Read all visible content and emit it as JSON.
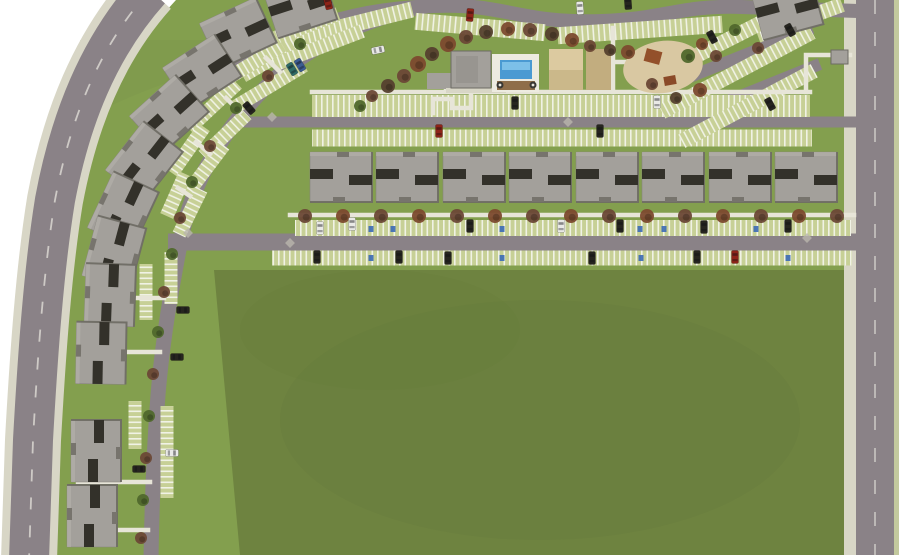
{
  "colors": {
    "page_bg": "#ffffff",
    "grass": "#839f4e",
    "grass_deep": "#76914a",
    "field": "#6e8340",
    "field_shade": "#64793a",
    "road": "#8a8287",
    "road_light": "#938c90",
    "dash": "#d9d7d1",
    "walk": "#e7e5d8",
    "verge": "#d8d6c6",
    "verge_green": "#c3c99e",
    "stripe_bg": "#c7d096",
    "stripe_white": "#f0f2e5",
    "wall": "#a3a09b",
    "wall_hi": "#b2afa9",
    "wall_edge": "#6e6b64",
    "slot": "#33312a",
    "vent": "#77746d",
    "pool": "#4a9ad2",
    "pool_hi": "#7cc0e8",
    "deck": "#edebe0",
    "patio": "#8f6e49",
    "sand": "#d9c8a2",
    "court1": "#dccaa0",
    "court2": "#cbb88a",
    "court3": "#c2ad7f",
    "equip": "#93502a",
    "kiosk": "#a3a09b",
    "diamond": "#b9b5ac",
    "handicap": "#3b6ab5",
    "tree_a": "#6b4836",
    "tree_b": "#55402e",
    "tree_g": "#50682c",
    "tree_o": "#7c4a2e",
    "car_k": "#26251f",
    "car_w": "#e9e9e6",
    "car_r": "#8e2418",
    "car_u": "#3b5c92",
    "car_t": "#2f6b66"
  },
  "canvas": {
    "w": 915,
    "h": 555
  },
  "site": {
    "grass_path": "M 176,0 C 124,55 96,130 80,210 C 68,280 62,360 57,450 L 53,558 L 899,558 L 899,0 Z",
    "field_poly": "214,270 848,270 848,555 240,555",
    "outer_road": {
      "d": "M 150,-10 C 98,48 70,120 55,200 C 44,268 38,350 33,440 L 29,560",
      "road_w": 40,
      "walk_w": 56
    },
    "right_road": {
      "verge": [
        844,
        0,
        12,
        555
      ],
      "road": [
        856,
        0,
        38,
        555
      ],
      "strip": [
        894,
        0,
        5,
        555
      ],
      "dash_x": 875
    },
    "roads": [
      {
        "d": "M 430,5 C 345,22 288,60 250,104 C 215,144 192,188 182,234 C 171,292 163,335 158,395 C 154,448 152,500 151,558",
        "w": 15
      },
      {
        "d": "M 230,74 C 292,28 352,9 434,6 C 505,3 520,24 602,21 C 665,19 680,5 742,7 L 858,11",
        "w": 14
      },
      {
        "d": "M 238,122 L 856,122",
        "w": 11
      },
      {
        "d": "M 168,242 L 858,242",
        "w": 17
      },
      {
        "d": "M 662,88 L 812,28",
        "w": 12
      },
      {
        "d": "M 676,122 L 820,64",
        "w": 12
      }
    ],
    "bands": [
      [
        573,
        228,
        556,
        16,
        0
      ],
      [
        562,
        258,
        580,
        15,
        0
      ],
      [
        561,
        106,
        498,
        22,
        0
      ],
      [
        562,
        138,
        500,
        17,
        0
      ],
      [
        282,
        52,
        92,
        16,
        -30
      ],
      [
        354,
        24,
        120,
        16,
        -14
      ],
      [
        480,
        27,
        130,
        17,
        5
      ],
      [
        640,
        30,
        165,
        17,
        -4
      ],
      [
        800,
        20,
        90,
        15,
        -20
      ],
      [
        747,
        30,
        120,
        15,
        -27
      ],
      [
        737,
        72,
        170,
        15,
        -28
      ],
      [
        748,
        106,
        150,
        15,
        -28
      ],
      [
        318,
        48,
        95,
        14,
        -21
      ],
      [
        270,
        86,
        80,
        14,
        -31
      ],
      [
        225,
        135,
        60,
        14,
        -44
      ],
      [
        205,
        170,
        62,
        14,
        -53
      ],
      [
        190,
        212,
        50,
        14,
        -64
      ],
      [
        296,
        30,
        90,
        14,
        -21
      ],
      [
        248,
        66,
        80,
        14,
        -31
      ],
      [
        213,
        106,
        66,
        14,
        -43
      ],
      [
        188,
        150,
        56,
        14,
        -55
      ],
      [
        176,
        195,
        46,
        14,
        -66
      ],
      [
        171,
        278,
        52,
        13,
        90
      ],
      [
        146,
        292,
        56,
        13,
        90
      ],
      [
        167,
        452,
        92,
        13,
        90
      ],
      [
        135,
        425,
        48,
        13,
        90
      ]
    ],
    "walks": [
      "M 290,215 L 854,215",
      "M 312,92 L 810,92",
      "M 433,113 L 433,99 L 452,99 L 452,108 L 471,108 L 471,92",
      "M 806,92 L 806,55 L 850,55",
      "M 613,92 L 613,28",
      "M 613,62 L 650,62",
      "M 650,62 L 650,92",
      "M 130,298 L 164,298",
      "M 125,352 L 160,352",
      "M 78,482 L 150,482",
      "M 99,456 L 99,482",
      "M 118,530 L 148,530",
      "M 266,58 L 280,72",
      "M 226,98 L 240,112",
      "M 196,142 L 210,154",
      "M 178,188 L 190,196",
      "M 446,90 L 506,90"
    ],
    "buildings": [
      [
        341,
        177,
        0
      ],
      [
        407,
        177,
        0
      ],
      [
        474,
        177,
        0
      ],
      [
        540,
        177,
        0
      ],
      [
        607,
        177,
        0
      ],
      [
        673,
        177,
        0
      ],
      [
        740,
        177,
        0
      ],
      [
        806,
        177,
        0
      ],
      [
        300,
        5,
        -18
      ],
      [
        238,
        33,
        -25
      ],
      [
        202,
        72,
        -33
      ],
      [
        169,
        114,
        -42
      ],
      [
        144,
        161,
        -52
      ],
      [
        123,
        210,
        -65
      ],
      [
        114,
        252,
        -75
      ],
      [
        110,
        295,
        -88
      ],
      [
        101,
        353,
        -89
      ],
      [
        96,
        451,
        -90
      ],
      [
        92,
        516,
        -90
      ],
      [
        787,
        8,
        -15
      ]
    ],
    "amenity": [
      {
        "t": "rect",
        "x": 427,
        "y": 73,
        "w": 26,
        "h": 16,
        "f": "$wall"
      },
      {
        "t": "rect",
        "x": 446,
        "y": 88,
        "w": 60,
        "h": 5,
        "f": "$verge"
      },
      {
        "t": "rect",
        "x": 451,
        "y": 51,
        "w": 40,
        "h": 37,
        "f": "$wall",
        "s": "$wall_edge"
      },
      {
        "t": "rect",
        "x": 456,
        "y": 56,
        "w": 22,
        "h": 27,
        "f": "#989590"
      },
      {
        "t": "rect",
        "x": 492,
        "y": 54,
        "w": 47,
        "h": 38,
        "f": "$deck"
      },
      {
        "t": "rect",
        "x": 500,
        "y": 60,
        "w": 32,
        "h": 19,
        "f": "$pool"
      },
      {
        "t": "rect",
        "x": 502,
        "y": 62,
        "w": 28,
        "h": 8,
        "f": "$pool_hi"
      },
      {
        "t": "rect",
        "x": 497,
        "y": 81,
        "w": 38,
        "h": 9,
        "f": "$patio"
      },
      {
        "t": "circle",
        "x": 500,
        "y": 85,
        "r": 3.5,
        "f": "#3a3833"
      },
      {
        "t": "circle",
        "x": 500,
        "y": 85,
        "r": 1.4,
        "f": "#e8e6dd"
      },
      {
        "t": "circle",
        "x": 533,
        "y": 85,
        "r": 3.5,
        "f": "#3a3833"
      },
      {
        "t": "circle",
        "x": 533,
        "y": 85,
        "r": 1.4,
        "f": "#e8e6dd"
      },
      {
        "t": "rect",
        "x": 549,
        "y": 49,
        "w": 34,
        "h": 41,
        "f": "$court2"
      },
      {
        "t": "rect",
        "x": 549,
        "y": 49,
        "w": 34,
        "h": 21,
        "f": "$court1"
      },
      {
        "t": "rect",
        "x": 586,
        "y": 49,
        "w": 25,
        "h": 41,
        "f": "$court3"
      },
      {
        "t": "rect",
        "x": 633,
        "y": 57,
        "w": 17,
        "h": 21,
        "f": "$wall",
        "s": "$wall_edge"
      },
      {
        "t": "rect",
        "x": 644,
        "y": 57,
        "w": 6,
        "h": 21,
        "f": "#7e5a3a"
      },
      {
        "t": "ellipse",
        "x": 663,
        "y": 67,
        "rx": 40,
        "ry": 26,
        "f": "$sand",
        "rot": -8
      },
      {
        "t": "rect",
        "x": 645,
        "y": 50,
        "w": 16,
        "h": 13,
        "f": "$equip",
        "rot": 15
      },
      {
        "t": "rect",
        "x": 664,
        "y": 76,
        "w": 12,
        "h": 9,
        "f": "#8a4a28",
        "rot": -10
      },
      {
        "t": "rect",
        "x": 831,
        "y": 50,
        "w": 17,
        "h": 14,
        "f": "$kiosk",
        "s": "$wall_edge"
      }
    ],
    "trees": [
      [
        305,
        216,
        7,
        "a"
      ],
      [
        343,
        216,
        7,
        "o"
      ],
      [
        381,
        216,
        7,
        "a"
      ],
      [
        419,
        216,
        7,
        "o"
      ],
      [
        457,
        216,
        7,
        "a"
      ],
      [
        495,
        216,
        7,
        "o"
      ],
      [
        533,
        216,
        7,
        "a"
      ],
      [
        571,
        216,
        7,
        "o"
      ],
      [
        609,
        216,
        7,
        "a"
      ],
      [
        647,
        216,
        7,
        "o"
      ],
      [
        685,
        216,
        7,
        "a"
      ],
      [
        723,
        216,
        7,
        "o"
      ],
      [
        761,
        216,
        7,
        "a"
      ],
      [
        799,
        216,
        7,
        "o"
      ],
      [
        837,
        216,
        7,
        "a"
      ],
      [
        418,
        64,
        8,
        "o"
      ],
      [
        404,
        76,
        7,
        "a"
      ],
      [
        388,
        86,
        7,
        "b"
      ],
      [
        432,
        54,
        7,
        "b"
      ],
      [
        448,
        44,
        8,
        "o"
      ],
      [
        466,
        37,
        7,
        "a"
      ],
      [
        486,
        32,
        7,
        "b"
      ],
      [
        508,
        29,
        7,
        "o"
      ],
      [
        530,
        30,
        7,
        "a"
      ],
      [
        552,
        34,
        7,
        "b"
      ],
      [
        572,
        40,
        7,
        "o"
      ],
      [
        590,
        46,
        6,
        "a"
      ],
      [
        610,
        50,
        6,
        "b"
      ],
      [
        372,
        96,
        6,
        "a"
      ],
      [
        360,
        106,
        6,
        "g"
      ],
      [
        628,
        52,
        7,
        "o"
      ],
      [
        652,
        84,
        6,
        "a"
      ],
      [
        688,
        56,
        7,
        "g"
      ],
      [
        702,
        44,
        6,
        "o"
      ],
      [
        716,
        56,
        6,
        "a"
      ],
      [
        700,
        90,
        7,
        "o"
      ],
      [
        676,
        98,
        6,
        "b"
      ],
      [
        735,
        30,
        6,
        "g"
      ],
      [
        758,
        48,
        6,
        "a"
      ],
      [
        300,
        44,
        6,
        "g"
      ],
      [
        268,
        76,
        6,
        "a"
      ],
      [
        236,
        108,
        6,
        "g"
      ],
      [
        210,
        146,
        6,
        "a"
      ],
      [
        192,
        182,
        6,
        "g"
      ],
      [
        180,
        218,
        6,
        "a"
      ],
      [
        172,
        254,
        6,
        "g"
      ],
      [
        164,
        292,
        6,
        "a"
      ],
      [
        158,
        332,
        6,
        "g"
      ],
      [
        153,
        374,
        6,
        "a"
      ],
      [
        149,
        416,
        6,
        "g"
      ],
      [
        146,
        458,
        6,
        "a"
      ],
      [
        143,
        500,
        6,
        "g"
      ],
      [
        141,
        538,
        6,
        "a"
      ]
    ],
    "cars": [
      [
        320,
        228,
        0,
        "w"
      ],
      [
        352,
        224,
        0,
        "w"
      ],
      [
        470,
        226,
        0,
        "k"
      ],
      [
        561,
        226,
        0,
        "w"
      ],
      [
        620,
        226,
        0,
        "k"
      ],
      [
        704,
        227,
        0,
        "k"
      ],
      [
        788,
        226,
        0,
        "k"
      ],
      [
        317,
        257,
        0,
        "k"
      ],
      [
        399,
        257,
        0,
        "k"
      ],
      [
        448,
        258,
        0,
        "k"
      ],
      [
        592,
        258,
        0,
        "k"
      ],
      [
        697,
        257,
        0,
        "k"
      ],
      [
        735,
        257,
        0,
        "r"
      ],
      [
        439,
        131,
        0,
        "r"
      ],
      [
        515,
        103,
        0,
        "k"
      ],
      [
        600,
        131,
        0,
        "k"
      ],
      [
        657,
        102,
        0,
        "w"
      ],
      [
        470,
        15,
        5,
        "r"
      ],
      [
        580,
        8,
        -4,
        "w"
      ],
      [
        628,
        3,
        -4,
        "k"
      ],
      [
        328,
        3,
        -14,
        "r"
      ],
      [
        712,
        37,
        -28,
        "k"
      ],
      [
        790,
        30,
        -28,
        "k"
      ],
      [
        770,
        104,
        -28,
        "k"
      ],
      [
        292,
        69,
        -31,
        "t"
      ],
      [
        300,
        65,
        -31,
        "u"
      ],
      [
        249,
        108,
        -41,
        "k"
      ],
      [
        378,
        50,
        78,
        "w"
      ],
      [
        183,
        310,
        90,
        "k"
      ],
      [
        177,
        357,
        90,
        "k"
      ],
      [
        172,
        453,
        90,
        "w"
      ],
      [
        139,
        469,
        90,
        "k"
      ]
    ],
    "handicap": [
      [
        371,
        229
      ],
      [
        393,
        229
      ],
      [
        502,
        229
      ],
      [
        640,
        229
      ],
      [
        664,
        229
      ],
      [
        756,
        229
      ],
      [
        371,
        258
      ],
      [
        502,
        258
      ],
      [
        641,
        258
      ],
      [
        788,
        258
      ]
    ],
    "diamonds": [
      [
        272,
        117
      ],
      [
        568,
        122
      ],
      [
        807,
        238
      ],
      [
        188,
        233
      ],
      [
        290,
        243
      ]
    ]
  }
}
